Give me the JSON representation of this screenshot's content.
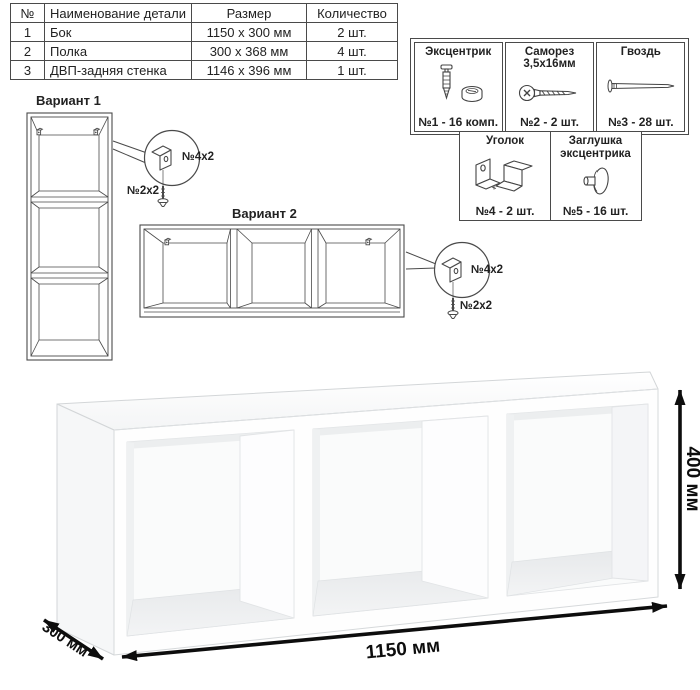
{
  "parts_table": {
    "headers": [
      "№",
      "Наименование детали",
      "Размер",
      "Количество"
    ],
    "rows": [
      {
        "num": "1",
        "name": "Бок",
        "size": "1150 x 300 мм",
        "qty": "2 шт."
      },
      {
        "num": "2",
        "name": "Полка",
        "size": "300 x 368 мм",
        "qty": "4 шт."
      },
      {
        "num": "3",
        "name": "ДВП-задняя стенка",
        "size": "1146 x 396 мм",
        "qty": "1 шт."
      }
    ]
  },
  "hardware": {
    "items": [
      {
        "title": "Эксцентрик",
        "count": "№1 - 16 комп.",
        "icon": "cam-lock"
      },
      {
        "title": "Саморез 3,5x16мм",
        "count": "№2 - 2 шт.",
        "icon": "screw"
      },
      {
        "title": "Гвоздь",
        "count": "№3 - 28 шт.",
        "icon": "nail"
      },
      {
        "title": "Уголок",
        "count": "№4 - 2 шт.",
        "icon": "angle-bracket"
      },
      {
        "title": "Заглушка эксцентрика",
        "count": "№5 - 16 шт.",
        "icon": "cam-cap"
      }
    ]
  },
  "variants": {
    "variant1_label": "Вариант 1",
    "variant2_label": "Вариант 2",
    "callout1": {
      "bracket_label": "№4х2",
      "screw_label": "№2х2"
    },
    "callout2": {
      "bracket_label": "№4х2",
      "screw_label": "№2х2"
    }
  },
  "dimensions": {
    "width": "1150 мм",
    "height": "400 мм",
    "depth": "300 мм"
  },
  "colors": {
    "line": "#4a4a4a",
    "dimension": "#0d0d0d",
    "shade": "#edeff1"
  }
}
